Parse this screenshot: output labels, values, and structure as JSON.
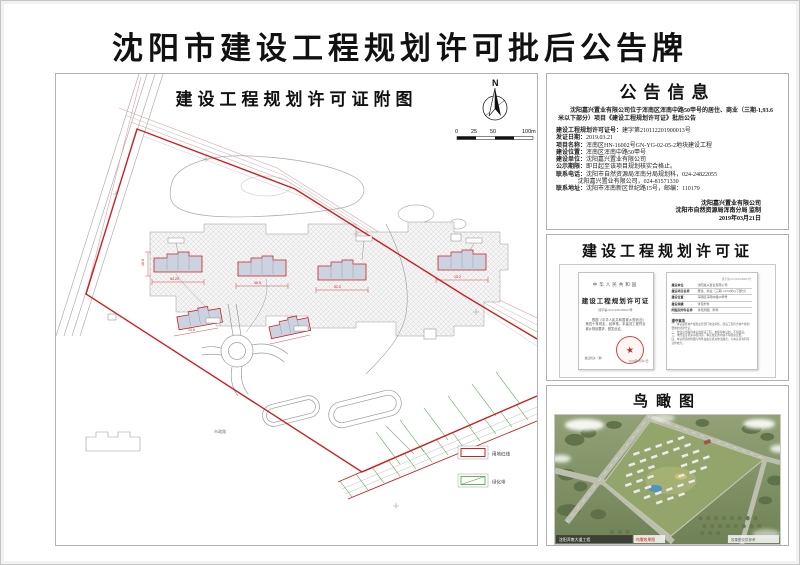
{
  "page": {
    "title": "沈阳市建设工程规划许可批后公告牌"
  },
  "map_panel": {
    "title": "建设工程规划许可证附图",
    "north_label": "N",
    "scale_ticks": [
      "0",
      "25",
      "50",
      "100m"
    ],
    "road_label": "市政路",
    "dims": [
      "54.20",
      "16.8",
      "46.5",
      "52.0",
      "15.2",
      "13.6"
    ],
    "legend": [
      {
        "label": "用地红线",
        "color": "#cf1f1f"
      },
      {
        "label": "绿化带",
        "color": "#3fa03f"
      }
    ]
  },
  "notice_panel": {
    "title": "公告信息",
    "intro": "沈阳嘉兴置业有限公司位于浑南区浑南中路50甲号的居住、商业（三期-1,93.6米以下部分）项目《建设工程规划许可证》批后公告",
    "fields": [
      {
        "label": "建设工程规划许可证号：",
        "value": "建字第210112201900013号"
      },
      {
        "label": "发证日期：",
        "value": "2019.03.21"
      },
      {
        "label": "项目名称：",
        "value": "浑南区HN-16002号GN-YG-02-05-2地块建设工程"
      },
      {
        "label": "建设位置：",
        "value": "浑南区浑南中路50甲号"
      },
      {
        "label": "建设单位：",
        "value": "沈阳嘉兴置业有限公司"
      },
      {
        "label": "公示期限：",
        "value": "即日起至该项目规划核实合格止。"
      },
      {
        "label": "联系电话：",
        "value": "沈阳市自然资源局浑南分局规划科，024-24822055"
      },
      {
        "label": "",
        "value": "沈阳嘉兴置业有限公司，024-81571330"
      },
      {
        "label": "联系地址：",
        "value": "沈阳市浑南新区世纪路15号，邮编：110179"
      }
    ],
    "signature": [
      "沈阳嘉兴置业有限公司",
      "沈阳市自然资源局浑南分局 监制",
      "2019年03月21日"
    ]
  },
  "permit_panel": {
    "title": "建设工程规划许可证",
    "cert_left": {
      "country": "中华人民共和国",
      "cert_title": "建设工程规划许可证",
      "cert_no": "建字第210112201900013号",
      "body": "根据《中华人民共和国城乡规划法》第四十条规定，经审核，本建设工程符合城乡规划要求，颁发此证。",
      "issuer_label": "发证机关（章）",
      "date": "2019年03月21日",
      "seal_star": "★"
    },
    "cert_right": {
      "header": "建字第210112201900013号",
      "rows": [
        {
          "k": "建设单位",
          "v": "沈阳嘉兴置业有限公司"
        },
        {
          "k": "建设项目名称",
          "v": "居住、商业（三期-1,93.6米以下部分）"
        },
        {
          "k": "建设位置",
          "v": "浑南区浑南中路50甲号"
        },
        {
          "k": "建设规模",
          "v": "详见附件"
        },
        {
          "k": "附图及附件名称",
          "v": "详见附图、附件"
        }
      ],
      "notes_title": "遵守事项",
      "notes": [
        "一、本证是经城乡规划主管部门依法审核，建设工程符合城乡规划要求的法律凭证。",
        "二、依法应当取得本证的建设工程，未取得本证的，不得建设。",
        "三、未经发证机关审核同意，本证规定的内容不得随意变更。",
        "四、本证所需的附图与附件由发证机关依法确定，与本证具有同等法律效力。"
      ]
    }
  },
  "bird_panel": {
    "title": "鸟瞰图",
    "caption_left": "沈阳浑南大道工程",
    "caption_red": "鸟瞰效果图",
    "caption_right": "效果图仅供参考"
  }
}
